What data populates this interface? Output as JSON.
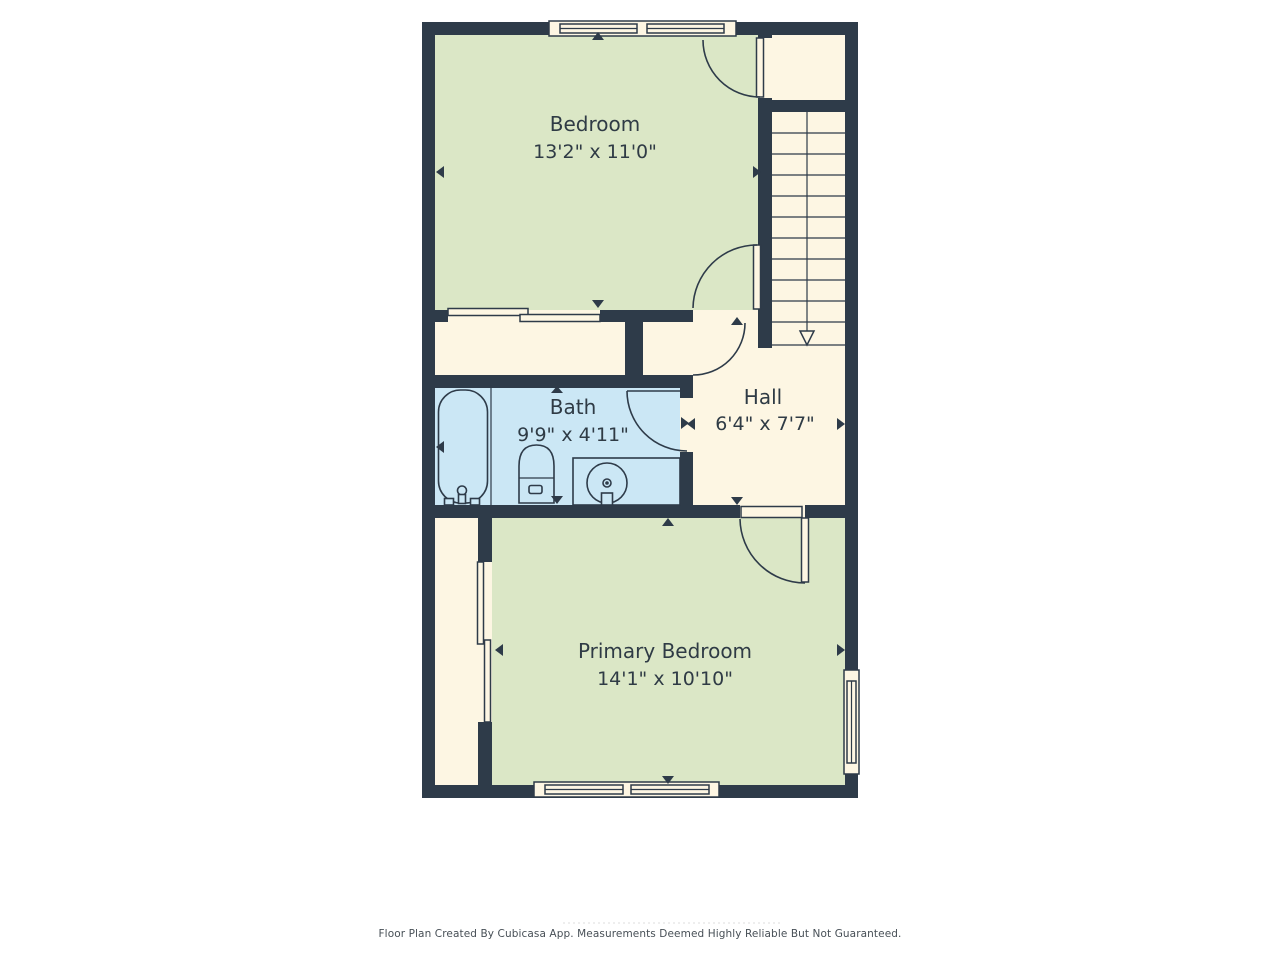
{
  "floor_plan": {
    "rooms": [
      {
        "id": "bedroom",
        "label": "Bedroom",
        "dimensions": "13'2\" x 11'0\""
      },
      {
        "id": "bath",
        "label": "Bath",
        "dimensions": "9'9\" x 4'11\""
      },
      {
        "id": "hall",
        "label": "Hall",
        "dimensions": "6'4\" x 7'7\""
      },
      {
        "id": "primary-bedroom",
        "label": "Primary Bedroom",
        "dimensions": "14'1\" x 10'10\""
      }
    ],
    "footer": "Floor Plan Created By Cubicasa App. Measurements Deemed Highly Reliable But Not Guaranteed.",
    "colors": {
      "wall": "#2e3b49",
      "green": "#dbe7c6",
      "cream": "#fdf6e3",
      "blue": "#cbe7f5",
      "line": "#2e3b49",
      "label": "#2f3b45",
      "footer": "#474f56"
    }
  }
}
